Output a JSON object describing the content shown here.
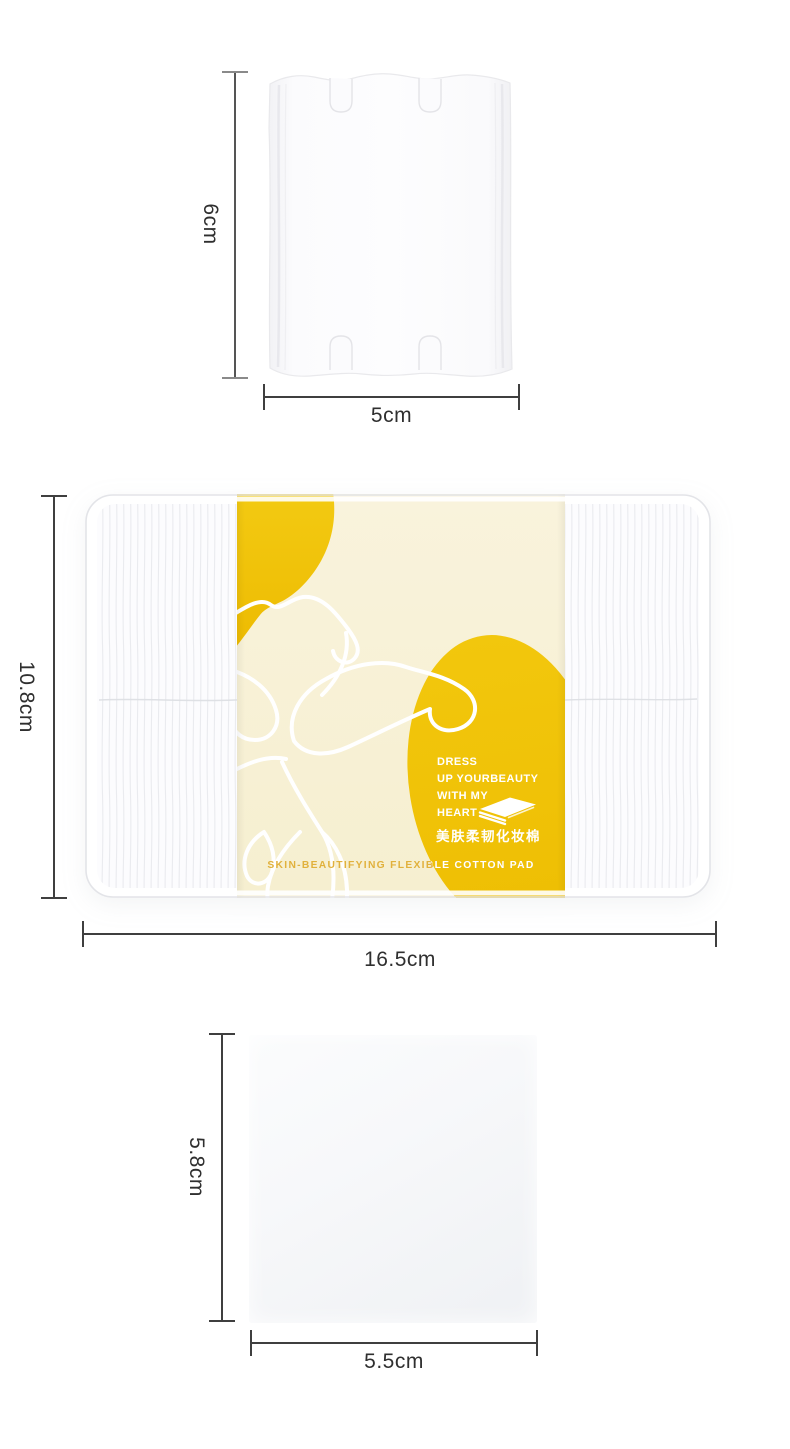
{
  "page": {
    "background": "#ffffff"
  },
  "colors": {
    "accent_yellow": "#F0C208",
    "label_cream": "#F8F1D6",
    "gold_text": "#E1B13C",
    "dimension_line": "#3F3F3F",
    "dimension_text": "#2F2F2F"
  },
  "sections": {
    "single_pad": {
      "name": "rectangular-cotton-pad",
      "height_label": "6cm",
      "width_label": "5cm"
    },
    "package": {
      "name": "cotton-pad-package",
      "height_label": "10.8cm",
      "width_label": "16.5cm",
      "label": {
        "slogan_lines": [
          "DRESS",
          "UP YOURBEAUTY",
          "WITH MY",
          "HEART"
        ],
        "product_name_zh": "美肤柔韧化妆棉",
        "product_name_en": "SKIN-BEAUTIFYING FLEXIBLE COTTON PAD"
      }
    },
    "square_pad": {
      "name": "square-cotton-pad",
      "height_label": "5.8cm",
      "width_label": "5.5cm"
    }
  },
  "icons": {
    "pad_stack": "cotton-pad-stack-icon"
  }
}
